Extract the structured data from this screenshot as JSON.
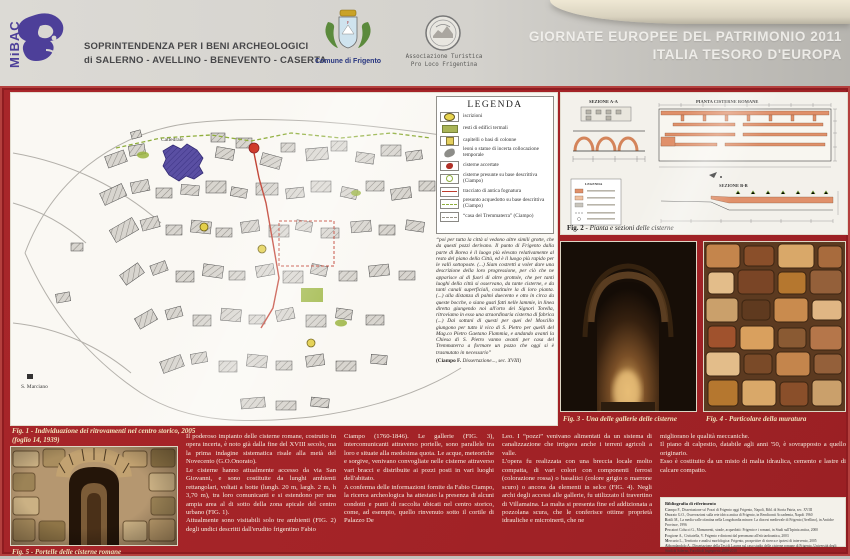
{
  "header": {
    "mibac_logo": "MiBAC",
    "soprintendenza_line1": "SOPRINTENDENZA PER I BENI ARCHEOLOGICI",
    "soprintendenza_line2": "di SALERNO - AVELLINO - BENEVENTO - CASERTA",
    "comune_label": "Comune di Frigento",
    "proloco_line1": "Associazione Turistica",
    "proloco_line2": "Pro Loco Frigentina",
    "event_line1": "GIORNATE EUROPEE DEL PATRIMONIO 2011",
    "event_line2": "ITALIA TESORO D'EUROPA"
  },
  "colors": {
    "board_red": "#a32327",
    "mibac_purple": "#4d3f99",
    "caption_cream": "#f1e3bb",
    "legend_green": "#a9b457",
    "sewer_red": "#bf3b2c",
    "aqueduct_green": "#8fae3c",
    "cathedral_purple": "#5a4fa3"
  },
  "map": {
    "label_cattedrale": "Cattedrale",
    "label_s_marciano": "S. Marciano"
  },
  "legend": {
    "title": "LEGENDA",
    "items": [
      {
        "icon": "inscription-oval",
        "label": "iscrizioni"
      },
      {
        "icon": "thermal-rect",
        "label": "resti di edifici termali"
      },
      {
        "icon": "capital-square",
        "label": "capitelli o basi di colonne"
      },
      {
        "icon": "statue-blob",
        "label": "leoni o statue di incerta collocazione temporale"
      },
      {
        "icon": "cistern-red-blob",
        "label": "cisterne accertate"
      },
      {
        "icon": "green-circle-outline",
        "label": "cisterne presunte su base descrittiva (Ciampo)"
      },
      {
        "icon": "red-line",
        "label": "tracciato di antica fognatura"
      },
      {
        "icon": "green-dashed-line",
        "label": "presunto acquedotto su base descrittiva (Ciampo)"
      },
      {
        "icon": "gray-dashed-line",
        "label": "“casa del Tremmaterra” (Ciampo)"
      }
    ]
  },
  "quote": {
    "text": "“poi per tutta la città  si vedono altre simili grotte, che da questi pozzi derivano. Il punto di Frigento dalla parte di Borea è il luogo più elevato relativamente al resto del piano della Città, ed è il luogo più rapido per le valli sottoposte. (...) Siam costretti a voler dare una descrizione della loro progressione, per ciò che ne apparisce al di fuori di altre grottole, che per tanti luoghi della città si osservano, da tante cisterne, e da tanti canali superficiali, costituire la di loro pianta. (...) alla distanza di palmi duecento e otto in circa da queste bocche, o siano gusti fatti nelle lammie, in linea diretta giungendo noi all'orto dei Signori Torella, ritroviamo in esso una straordinaria cisterna di fabrica (...) Dai sottani di questi per quei del Moscillo  giungono per tutto il vico di S. Pietro per quelli del Mag.co Pietro Gaetano Flammia, e andando avanti la Chiesa di S. Pietro vanno avanti per casa del Tremmaterra a formare un pozzo che oggi si è trasmutato in necessario”",
    "attribution_author": "(Ciampo F.",
    "attribution_rest": " Dissertazione..., sec. XVIII)"
  },
  "figures": {
    "fig1_caption_line1": "Fig. 1 - Individuazione dei ritrovamenti nel centro storico, 2005",
    "fig1_caption_line2": "(foglio 14, 1939)",
    "fig2_caption_label": "Fig. 2",
    "fig2_caption_text": " - Pianta e sezioni delle cisterne",
    "fig3_caption": "Fig. 3 - Una delle gallerie delle cisterne",
    "fig4_caption": "Fig. 4 - Particolare della muratura",
    "fig5_caption": "Fig. 5 - Portelle delle cisterne romane"
  },
  "fig2_labels": {
    "sezione_aa": "SEZIONE A-A",
    "pianta": "PIANTA CISTERNE ROMANE",
    "sezione_bb": "SEZIONE B-B",
    "legenda": "LEGENDA"
  },
  "body_text": {
    "col1_p1": "Il poderoso impianto delle cisterne romane, costruito in opera incerta, è noto già dalla fine del XVIII secolo, ma la prima indagine sistematica risale alla metà del Novecento (G.O.Onorato).",
    "col1_p2": "Le cisterne hanno attualmente accesso da via San Giovanni, e sono costituite da lunghi ambienti rettangolari, voltati a botte (lungh. 20 m, largh. 2 m, h 3,70 m), tra loro comunicanti e si estendono per una ampia area al di sotto della zona apicale del centro urbano (FIG. 1).",
    "col1_p3": "Attualmente sono visitabili solo tre ambienti (FIG. 2) degli undici descritti dall'erudito frigentino Fabio",
    "col2_p1": "Ciampo (1760-1846). Le gallerie (FIG. 3), intercomunicanti attraverso portelle, sono parallele tra loro e situate alla medesima quota. Le acque, meteoriche e sorgive, venivano convogliate nelle cisterne attraverso vari bracci e distribuite ai pozzi posti in vari luoghi dell'abitato.",
    "col2_p2": "A conferma delle informazioni fornite da Fabio Ciampo, la ricerca archeologica ha attestato la presenza di alcuni condotti e punti di raccolta ubicati nel centro storico, come, ad esempio, quello rinvenuto sotto il cortile di Palazzo De",
    "col3_p1": "Leo. I “pozzi” venivano alimentati da un sistema di canalizzazione che irrigava anche i terreni agricoli a valle.",
    "col3_p2": "L'opera fu realizzata con una breccia locale molto compatta, di vari colori con componenti ferrosi (colorazione rossa) o basaltici (colore grigio o marrone scuro) o ancora da elementi in selce (FIG. 4). Negli archi degli accessi alle gallerie, fu utilizzato il travertino di Villamaina. La malta si presenta fine ed addizionata a pozzolana scura, che le conferisce ottime proprietà idrauliche e microinerti, che ne",
    "col4_p1": "migliorano le qualità meccaniche.",
    "col4_p2": "Il piano di calpestio, databile agli anni '50, è sovrapposto a quello originario.",
    "col4_p3": "Esso è costituito da un misto di  malta idraulica, cemento e lastre di calcare compatto."
  },
  "bibliography": {
    "title": "Bibliografia di riferimento",
    "entries": [
      "Ciampo F., Dissertazione su' Pozzi di Frigento oggi Frigento, Napoli, Bibl. di Storia Patria, sec. XVIII",
      "Onorato G.O., Osservazioni sulla rete idrica antica di Frigento, in Rendiconti Accademia, Napoli 1960",
      "Rotili M., La media valle ofantina nella Longobardia minore. La diocesi medievale di Frigento (Avellino), in Antiche Province, 1996",
      "Pescatori Colucci G., Monumenti, strade, acquedotti: Frigento e i romani, in Studi sull'Irpinia antica, 2000",
      "Forgione A., Civitatella, V. Frigento e dintorni dal preromano all'età tardoantica, 2003",
      "Mercurio L., Territorio e analisi morfologica: Frigento, prospettive di ricerca e ipotesi di intervento, 2005",
      "Abbondandolo A., Dissertazione della Tesi di Laurea sul caso studio delle cisterne romane di Frigento, Università degli Studi di Salerno, Facoltà di Ingegneria 2009-2010"
    ]
  }
}
